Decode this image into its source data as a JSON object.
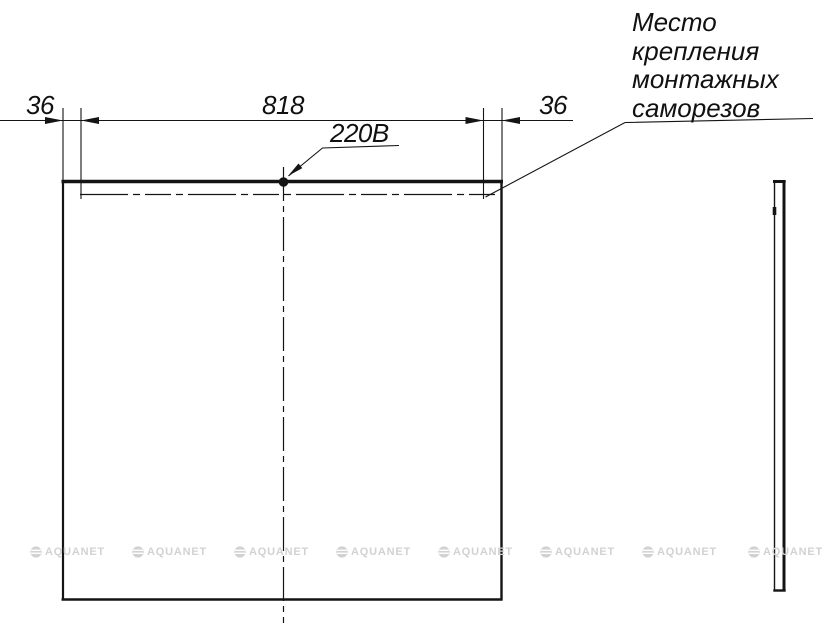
{
  "drawing": {
    "title": "Mirror mounting technical drawing",
    "dimensions": {
      "left_offset": "36",
      "span": "818",
      "right_offset": "36"
    },
    "labels": {
      "power": "220В",
      "mounting_note": "Место\nкрепления\nмонтажных\nсаморезов"
    },
    "watermark": {
      "text": "AQUANET",
      "logo_icon": "aquanet-circle-logo",
      "color": "#d2d2d2"
    },
    "colors": {
      "line": "#141414",
      "background": "#ffffff"
    }
  }
}
